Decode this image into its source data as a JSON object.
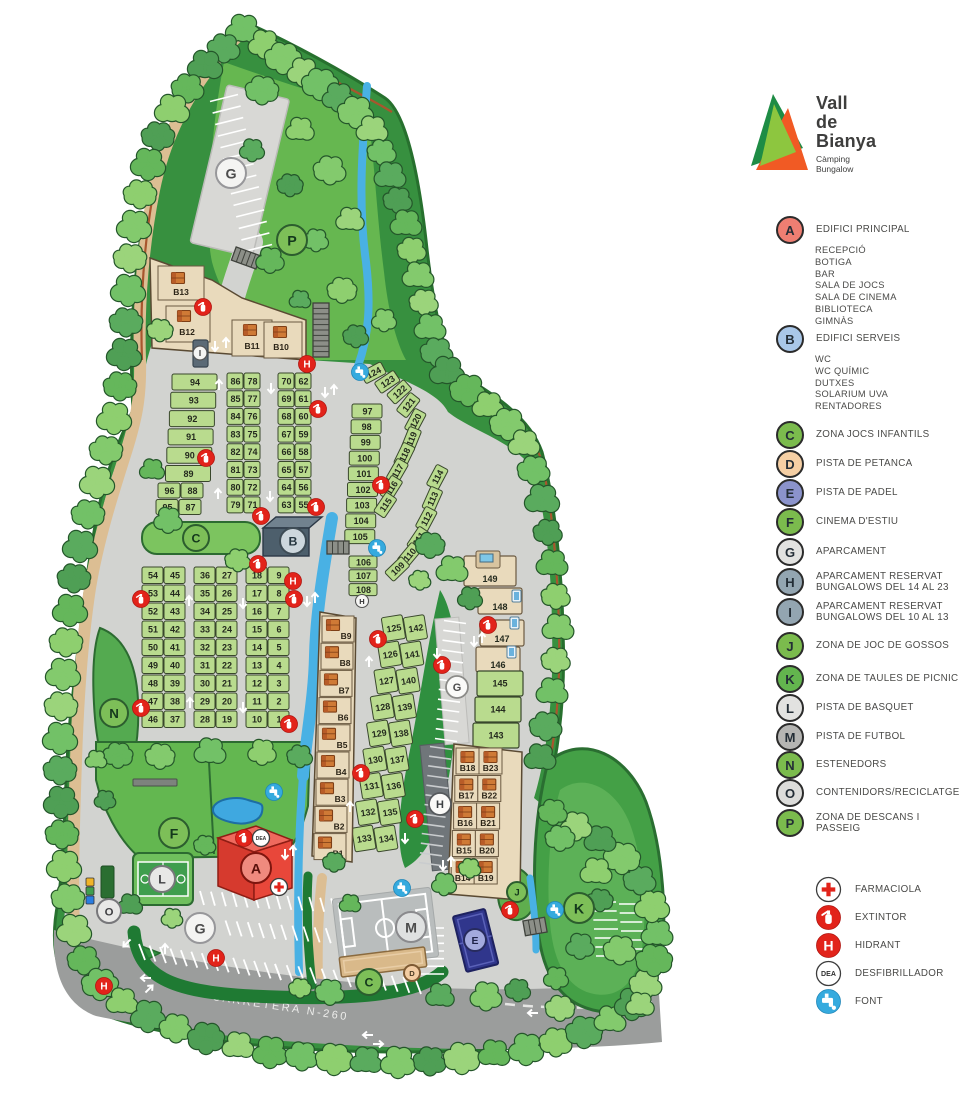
{
  "logo": {
    "title_lines": [
      "Vall",
      "de",
      "Bianya"
    ],
    "subtitle_lines": [
      "Càmping",
      "Bungalow"
    ],
    "colors": {
      "dark_green": "#1e8c45",
      "light_green": "#8dc63f",
      "orange": "#f15a24"
    }
  },
  "legend": {
    "zones": [
      {
        "letter": "A",
        "label": "EDIFICI PRINCIPAL",
        "color": "#ee7e72",
        "sublabels": [
          "RECEPCIÓ",
          "BOTIGA",
          "BAR",
          "SALA DE JOCS",
          "SALA DE CINEMA",
          "BIBLIOTECA",
          "GIMNÀS"
        ]
      },
      {
        "letter": "B",
        "label": "EDIFICI SERVEIS",
        "color": "#a9c7e8",
        "sublabels": [
          "WC",
          "WC QUÍMIC",
          "DUTXES",
          "SOLARIUM UVA",
          "RENTADORES"
        ]
      },
      {
        "letter": "C",
        "label": "ZONA JOCS INFANTILS",
        "color": "#7bbb4d"
      },
      {
        "letter": "D",
        "label": "PISTA DE  PETANCA",
        "color": "#f5cfa4"
      },
      {
        "letter": "E",
        "label": "PISTA  DE PADEL",
        "color": "#8b93cc"
      },
      {
        "letter": "F",
        "label": "CINEMA D'ESTIU",
        "color": "#7bbb4d"
      },
      {
        "letter": "G",
        "label": "APARCAMENT",
        "color": "#e2e2e0"
      },
      {
        "letter": "H",
        "label": "APARCAMENT RESERVAT",
        "label2": "BUNGALOWS DEL 14 AL 23",
        "color": "#93a5b1"
      },
      {
        "letter": "I",
        "label": "APARCAMENT RESERVAT",
        "label2": "BUNGALOWS DEL 10 AL 13",
        "color": "#93a5b1"
      },
      {
        "letter": "J",
        "label": "ZONA DE JOC DE GOSSOS",
        "color": "#7bbb4d"
      },
      {
        "letter": "K",
        "label": "ZONA DE TAULES DE PICNIC",
        "color": "#63b54e"
      },
      {
        "letter": "L",
        "label": "PISTA DE BASQUET",
        "color": "#e2e2e0"
      },
      {
        "letter": "M",
        "label": "PISTA DE FUTBOL",
        "color": "#b5b5b3"
      },
      {
        "letter": "N",
        "label": "ESTENEDORS",
        "color": "#7bbb4d"
      },
      {
        "letter": "O",
        "label": "CONTENIDORS/RECICLATGE",
        "color": "#dcdcda"
      },
      {
        "letter": "P",
        "label": "ZONA DE DESCANS I PASSEIG",
        "color": "#7bbb4d"
      }
    ],
    "symbols": [
      {
        "name": "farmaciola-icon",
        "label": "FARMACIOLA"
      },
      {
        "name": "extintor-icon",
        "label": "EXTINTOR"
      },
      {
        "name": "hidrant-icon",
        "label": "HIDRANT"
      },
      {
        "name": "dea-icon",
        "label": "DESFIBRILLADOR",
        "icon_text": "DEA"
      },
      {
        "name": "font-icon",
        "label": "FONT"
      }
    ]
  },
  "map": {
    "road_label": "CARRETERA N-260",
    "zone_markers": [
      "G",
      "P",
      "C",
      "B",
      "N",
      "F",
      "L",
      "A",
      "O",
      "G",
      "M",
      "E",
      "D",
      "C",
      "J",
      "K"
    ],
    "parking_markers": [
      "G",
      "H",
      "I"
    ],
    "small_markers": [
      "H"
    ],
    "plots": {
      "rows_94_89": [
        "94",
        "93",
        "92",
        "91",
        "90",
        "89"
      ],
      "rows_96_87": [
        [
          "96",
          "88"
        ],
        [
          "95",
          "87"
        ]
      ],
      "rows_86_71": [
        [
          "86",
          "78"
        ],
        [
          "85",
          "77"
        ],
        [
          "84",
          "76"
        ],
        [
          "83",
          "75"
        ],
        [
          "82",
          "74"
        ],
        [
          "81",
          "73"
        ],
        [
          "80",
          "72"
        ],
        [
          "79",
          "71"
        ]
      ],
      "rows_70_55": [
        [
          "70",
          "62"
        ],
        [
          "69",
          "61"
        ],
        [
          "68",
          "60"
        ],
        [
          "67",
          "59"
        ],
        [
          "66",
          "58"
        ],
        [
          "65",
          "57"
        ],
        [
          "64",
          "56"
        ],
        [
          "63",
          "55"
        ]
      ],
      "rows_97_105": [
        "97",
        "98",
        "99",
        "100",
        "101",
        "102",
        "103",
        "104",
        "105"
      ],
      "rows_106_108": [
        "106",
        "107",
        "108"
      ],
      "diag_124_115": [
        "124",
        "123",
        "122",
        "121",
        "120",
        "119",
        "118",
        "117",
        "116",
        "115"
      ],
      "diag_114_109": [
        "114",
        "113",
        "112",
        "111",
        "110",
        "109"
      ],
      "rows_54_37": [
        [
          "54",
          "45"
        ],
        [
          "53",
          "44"
        ],
        [
          "52",
          "43"
        ],
        [
          "51",
          "42"
        ],
        [
          "50",
          "41"
        ],
        [
          "49",
          "40"
        ],
        [
          "48",
          "39"
        ],
        [
          "47",
          "38"
        ],
        [
          "46",
          "37"
        ]
      ],
      "rows_36_19": [
        [
          "36",
          "27"
        ],
        [
          "35",
          "26"
        ],
        [
          "34",
          "25"
        ],
        [
          "33",
          "24"
        ],
        [
          "32",
          "23"
        ],
        [
          "31",
          "22"
        ],
        [
          "30",
          "21"
        ],
        [
          "29",
          "20"
        ],
        [
          "28",
          "19"
        ]
      ],
      "rows_18_1": [
        [
          "18",
          "9"
        ],
        [
          "17",
          "8"
        ],
        [
          "16",
          "7"
        ],
        [
          "15",
          "6"
        ],
        [
          "14",
          "5"
        ],
        [
          "13",
          "4"
        ],
        [
          "12",
          "3"
        ],
        [
          "11",
          "2"
        ],
        [
          "10",
          "1"
        ]
      ],
      "rows_125_134": [
        [
          "125",
          "142"
        ],
        [
          "126",
          "141"
        ],
        [
          "127",
          "140"
        ],
        [
          "128",
          "139"
        ],
        [
          "129",
          "138"
        ],
        [
          "130",
          "137"
        ],
        [
          "131",
          "136"
        ],
        [
          "132",
          "135"
        ],
        [
          "133",
          "134"
        ]
      ],
      "rows_149_143": [
        "149",
        "148",
        "147",
        "146",
        "145",
        "144",
        "143"
      ]
    },
    "bungalows": {
      "top": [
        "B13",
        "B12",
        "B11",
        "B10"
      ],
      "left": [
        "B9",
        "B8",
        "B7",
        "B6",
        "B5",
        "B4",
        "B3",
        "B2",
        "B1"
      ],
      "right": [
        [
          "B18",
          "B23"
        ],
        [
          "B17",
          "B22"
        ],
        [
          "B16",
          "B21"
        ],
        [
          "B15",
          "B20"
        ],
        [
          "B14",
          "B19"
        ]
      ]
    }
  }
}
